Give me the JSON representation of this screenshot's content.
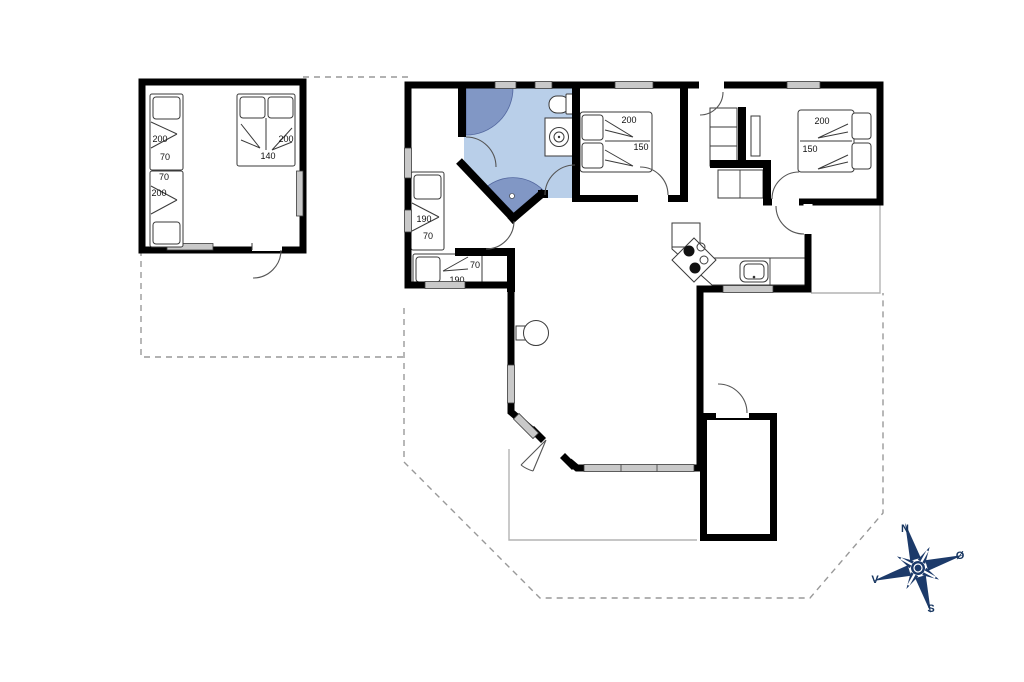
{
  "floorplan": {
    "colors": {
      "wall": "#000000",
      "bathroom_floor": "#b9cfe9",
      "bathroom_fixture": "#8197c5",
      "window_fill": "#c9c9c9",
      "dashed_boundary": "#999999",
      "terrace_outline": "#b3b3b3",
      "compass": "#1c3a6a"
    },
    "labels": {
      "annex": {
        "single_top_len": "200",
        "single_top_wid": "70",
        "single_bot_wid": "70",
        "single_bot_len": "200",
        "double_len": "200",
        "double_wid": "140"
      },
      "bedroom_west": {
        "bed_left_len": "190",
        "bed_left_wid": "70",
        "bed_bottom_wid": "70",
        "bed_bottom_len": "190"
      },
      "bedroom_middle": {
        "len": "200",
        "wid": "150"
      },
      "bedroom_east": {
        "len": "200",
        "wid": "150"
      }
    },
    "compass": {
      "north": "N",
      "east": "Ø",
      "south": "S",
      "west": "V"
    }
  }
}
